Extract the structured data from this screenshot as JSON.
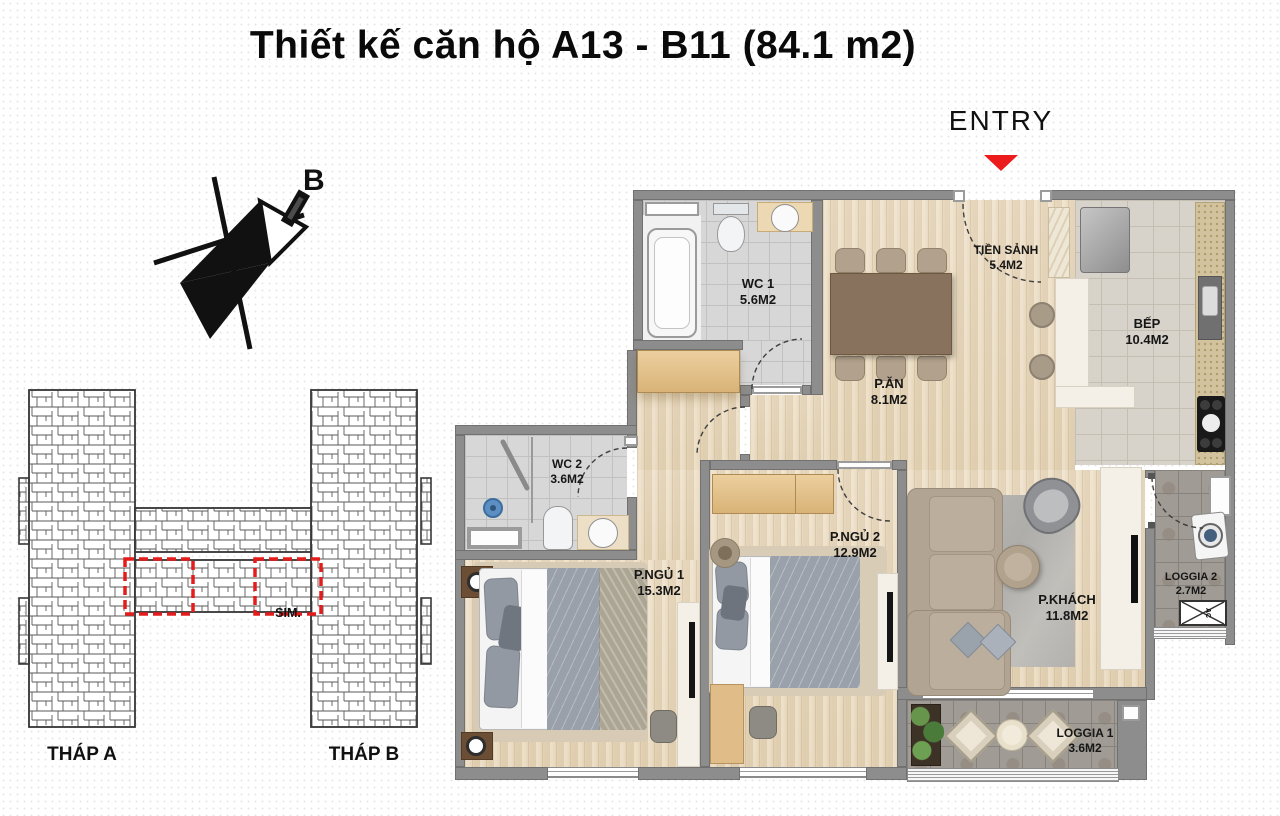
{
  "title": "Thiết kế căn hộ A13 - B11 (84.1 m2)",
  "entry_label": "ENTRY",
  "compass_label": "B",
  "site_plan": {
    "tower_a_label": "THÁP A",
    "tower_b_label": "THÁP B",
    "sim_label": "SIM.",
    "highlight_color": "#e81c1c"
  },
  "rooms": [
    {
      "id": "wc1",
      "name": "WC 1",
      "area": "5.6M2"
    },
    {
      "id": "tien-sanh",
      "name": "TIỀN SẢNH",
      "area": "5.4M2"
    },
    {
      "id": "bep",
      "name": "BẾP",
      "area": "10.4M2"
    },
    {
      "id": "p-an",
      "name": "P.ĂN",
      "area": "8.1M2"
    },
    {
      "id": "wc2",
      "name": "WC 2",
      "area": "3.6M2"
    },
    {
      "id": "p-ngu-1",
      "name": "P.NGỦ 1",
      "area": "15.3M2"
    },
    {
      "id": "p-ngu-2",
      "name": "P.NGỦ 2",
      "area": "12.9M2"
    },
    {
      "id": "p-khach",
      "name": "P.KHÁCH",
      "area": "11.8M2"
    },
    {
      "id": "loggia-2",
      "name": "LOGGIA 2",
      "area": "2.7M2"
    },
    {
      "id": "loggia-1",
      "name": "LOGGIA 1",
      "area": "3.6M2"
    }
  ],
  "ac_label": "AC",
  "colors": {
    "wall": "#8d8d8d",
    "accent_red": "#ed1c1c",
    "wood_floor": "#ead9bd",
    "wc_tile": "#d7d7d7",
    "kitchen_tile": "#d8d3ca",
    "loggia_tile": "#a09c95"
  }
}
